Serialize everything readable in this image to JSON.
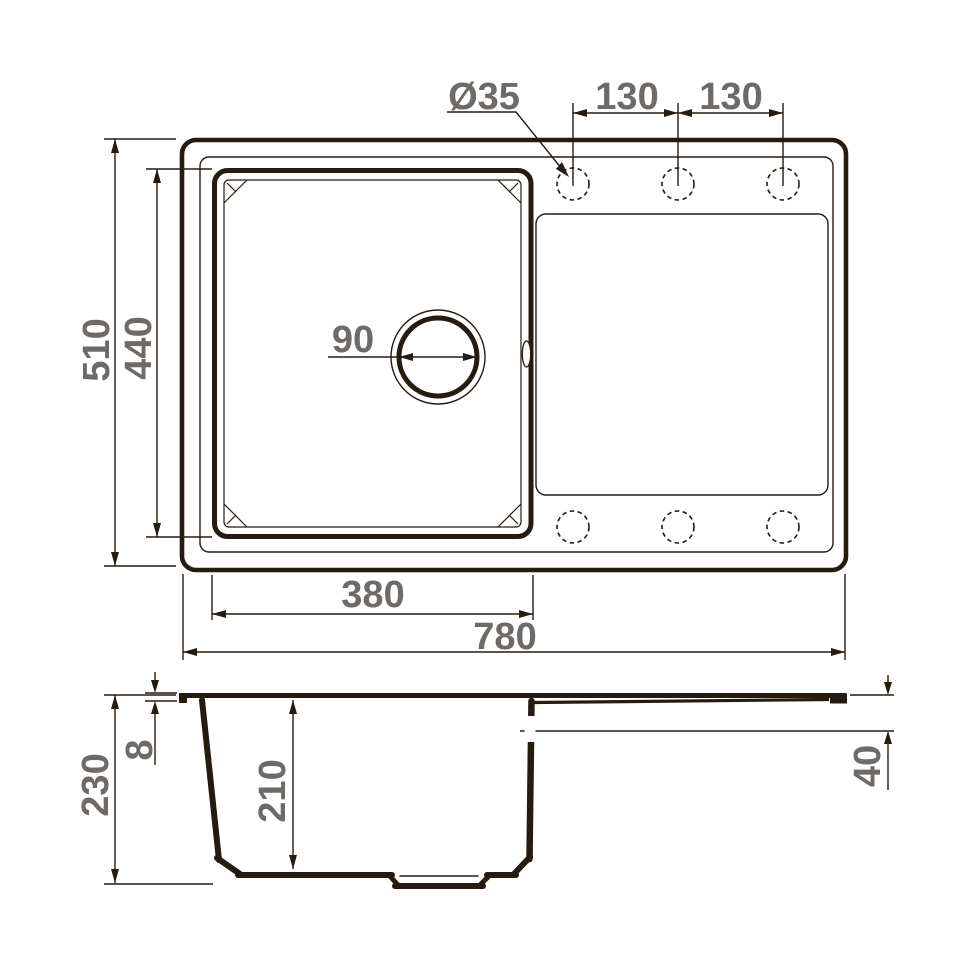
{
  "drawing": {
    "title": "sink-dimension-drawing",
    "colors": {
      "line": "#241b11",
      "text": "#6e6a67",
      "background": "#ffffff"
    },
    "top_view": {
      "faucet_hole_diameter": "Ø35",
      "hole_spacing_left": "130",
      "hole_spacing_right": "130",
      "overall_depth": "510",
      "bowl_outer_depth": "440",
      "drain_diameter": "90",
      "bowl_width": "380",
      "overall_width": "780"
    },
    "side_view": {
      "overall_height": "230",
      "rim_thickness": "8",
      "bowl_inner_depth": "210",
      "drainboard_drop": "40"
    }
  }
}
